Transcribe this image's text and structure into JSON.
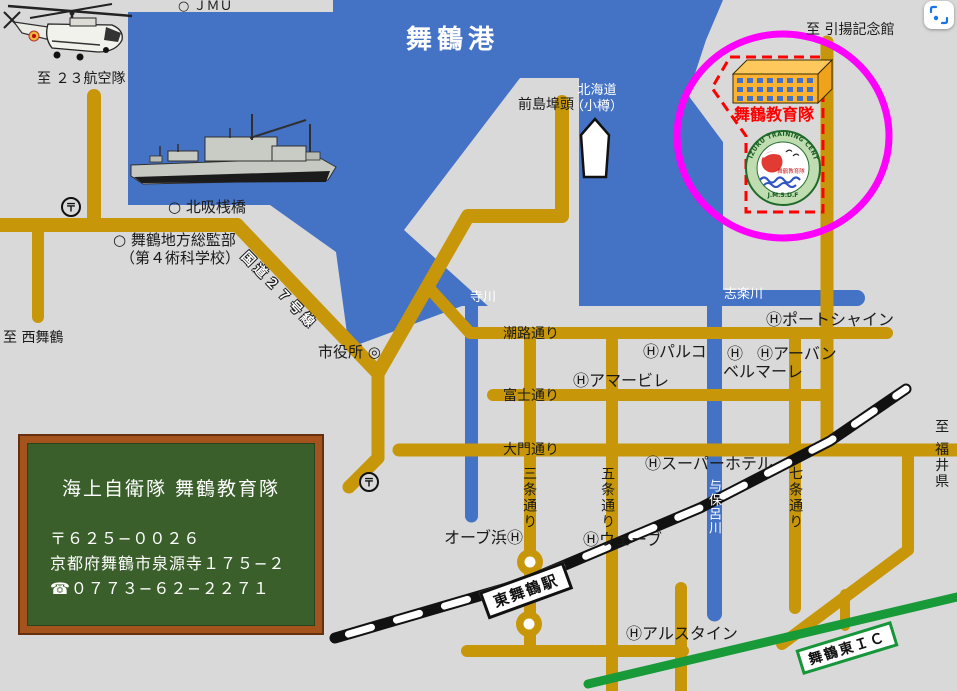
{
  "sea": {
    "port": "舞鶴港",
    "rivers": {
      "terakawa": "寺川",
      "shirakugawa": "志楽川",
      "yohorogawa": "与保呂川"
    },
    "ferry_dest_l1": "北海道",
    "ferry_dest_l2": "（小樽）"
  },
  "destinations": {
    "air_squadron": "至 ２３航空隊",
    "nishi_maizuru": "至 西舞鶴",
    "hikiage_museum": "至 引揚記念館",
    "fukui": "至 福井県"
  },
  "places": {
    "jmu": "○ ＪＭＵ",
    "maejima_wharf": "前島埠頭",
    "kitasui_pier": "○ 北吸桟橋",
    "district_hq_l1": "○ 舞鶴地方総監部",
    "district_hq_l2": "（第４術科学校）",
    "city_hall": "市役所 ◎",
    "station": "東舞鶴駅",
    "interchange": "舞鶴東ＩＣ",
    "post_office": "〒"
  },
  "streets": {
    "route27": "国道２７号線",
    "shioji": "潮路通り",
    "fuji": "富士通り",
    "daimon": "大門通り",
    "sanjo": "三条通り",
    "gojo": "五条通り",
    "shichijo": "七条通り"
  },
  "hotels": {
    "port_shine": "Ⓗポートシャイン",
    "parco": "Ⓗパルコ",
    "h_mark": "Ⓗ",
    "urban": "Ⓗアーバン",
    "bellmare": "ベルマーレ",
    "amabile": "Ⓗアマービレ",
    "super_hotel": "Ⓗスーパーホテル",
    "orb_hama": "オーブ浜Ⓗ",
    "wave": "Ⓗウェーブ",
    "alstein": "Ⓗアルスタイン"
  },
  "training_center": {
    "name": "舞鶴教育隊",
    "emblem_top": "MAIZURU TRAINING CENTER",
    "emblem_bottom": "J.M.S.D.F",
    "emblem_inner": "舞鶴教育隊"
  },
  "info_board": {
    "title": "海上自衛隊 舞鶴教育隊",
    "postal": "〒６２５−００２６",
    "address": "京都府舞鶴市泉源寺１７５−２",
    "phone": "☎０７７３−６２−２２７１"
  },
  "colors": {
    "water": "#4472C4",
    "land": "#D9D9D9",
    "road": "#C79709",
    "highway_green": "#189A38",
    "highlight_magenta": "#FF00FF",
    "site_red": "#FF0000",
    "board_green": "#3A5F2B",
    "board_frame": "#A5531C"
  }
}
